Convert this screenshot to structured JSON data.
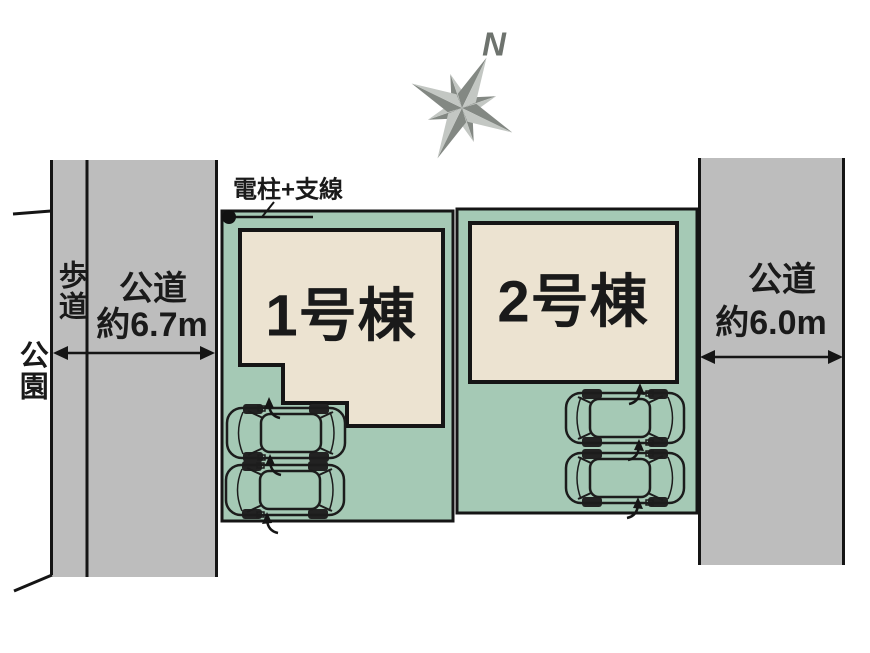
{
  "compass": {
    "north_label": "N"
  },
  "utility_pole": {
    "label": "電柱+支線"
  },
  "left_area": {
    "park_label": "公園",
    "sidewalk_label": "歩道",
    "road_label": "公道",
    "road_width": "約6.7m"
  },
  "right_area": {
    "road_label": "公道",
    "road_width": "約6.0m"
  },
  "plots": [
    {
      "building_label": "1号棟",
      "parking_spaces": 2,
      "parking_direction": "left"
    },
    {
      "building_label": "2号棟",
      "parking_spaces": 2,
      "parking_direction": "right"
    }
  ],
  "colors": {
    "plot-green": "#a5c9b5",
    "building-beige": "#ece3d1",
    "road-gray": "#bdbdbd",
    "outline": "#151515",
    "compass-dark": "#838883",
    "compass-light": "#c3c7c3"
  }
}
